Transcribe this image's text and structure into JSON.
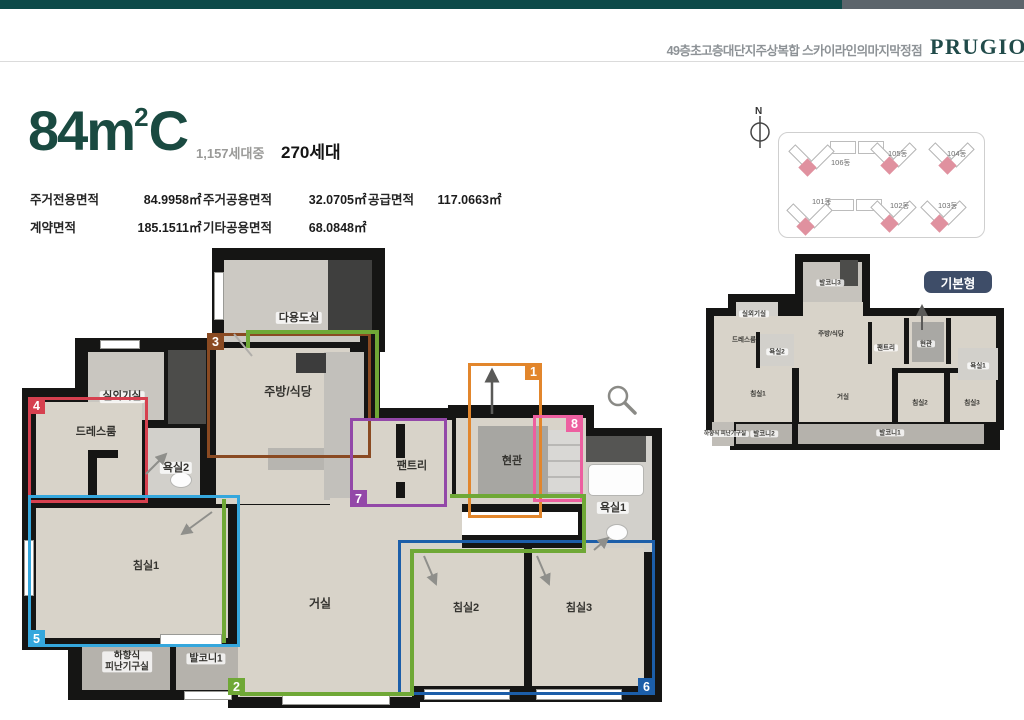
{
  "page": {
    "top_bar_teal": "#0d4a49",
    "top_bar_gray": "#5d656c",
    "accent_green": "#1a4a41"
  },
  "header": {
    "slogan": "49층초고층대단지주상복합 스카이라인의마지막정점",
    "logo": "PRUGIO",
    "logo_color": "#214b4a"
  },
  "title": {
    "size": "84m",
    "sup": "2",
    "type": "C",
    "units_prefix": "1,157세대중",
    "units_value": "270세대"
  },
  "area_table": {
    "cells": [
      {
        "label": "주거전용면적",
        "value": "84.9958㎡"
      },
      {
        "label": "주거공용면적",
        "value": "32.0705㎡"
      },
      {
        "label": "공급면적",
        "value": "117.0663㎡"
      },
      {
        "label": "계약면적",
        "value": "185.1511㎡"
      },
      {
        "label": "기타공용면적",
        "value": "68.0848㎡"
      }
    ]
  },
  "site_plan": {
    "compass": "N",
    "highlight_color": "#e0919f",
    "buildings": [
      {
        "name": "106동"
      },
      {
        "name": "105동"
      },
      {
        "name": "104동"
      },
      {
        "name": "101동"
      },
      {
        "name": "102동"
      },
      {
        "name": "103동"
      }
    ]
  },
  "mini_plan": {
    "badge": "기본형",
    "badge_color": "#3e4d68",
    "rooms": [
      "발코니3",
      "실외기실",
      "드레스룸",
      "욕실2",
      "주방/식당",
      "팬트리",
      "현관",
      "욕실1",
      "침실1",
      "거실",
      "침실2",
      "침실3",
      "하향식\n피난기구실",
      "발코니2",
      "발코니1"
    ]
  },
  "main_plan": {
    "rooms": [
      "다용도실",
      "주방/식당",
      "실외기실",
      "드레스룸",
      "욕실2",
      "팬트리",
      "현관",
      "욕실1",
      "침실1",
      "거실",
      "침실2",
      "침실3",
      "하향식\n피난기구실",
      "발코니1"
    ],
    "markers": [
      {
        "num": "1",
        "color": "#e2862c"
      },
      {
        "num": "2",
        "color": "#6fa836"
      },
      {
        "num": "3",
        "color": "#8a4a22"
      },
      {
        "num": "4",
        "color": "#d6404f"
      },
      {
        "num": "5",
        "color": "#35a7dd"
      },
      {
        "num": "6",
        "color": "#1c5ea9"
      },
      {
        "num": "7",
        "color": "#9348a8"
      },
      {
        "num": "8",
        "color": "#ed5fa0"
      }
    ],
    "icons": {
      "magnifier": "magnifier-icon"
    }
  }
}
